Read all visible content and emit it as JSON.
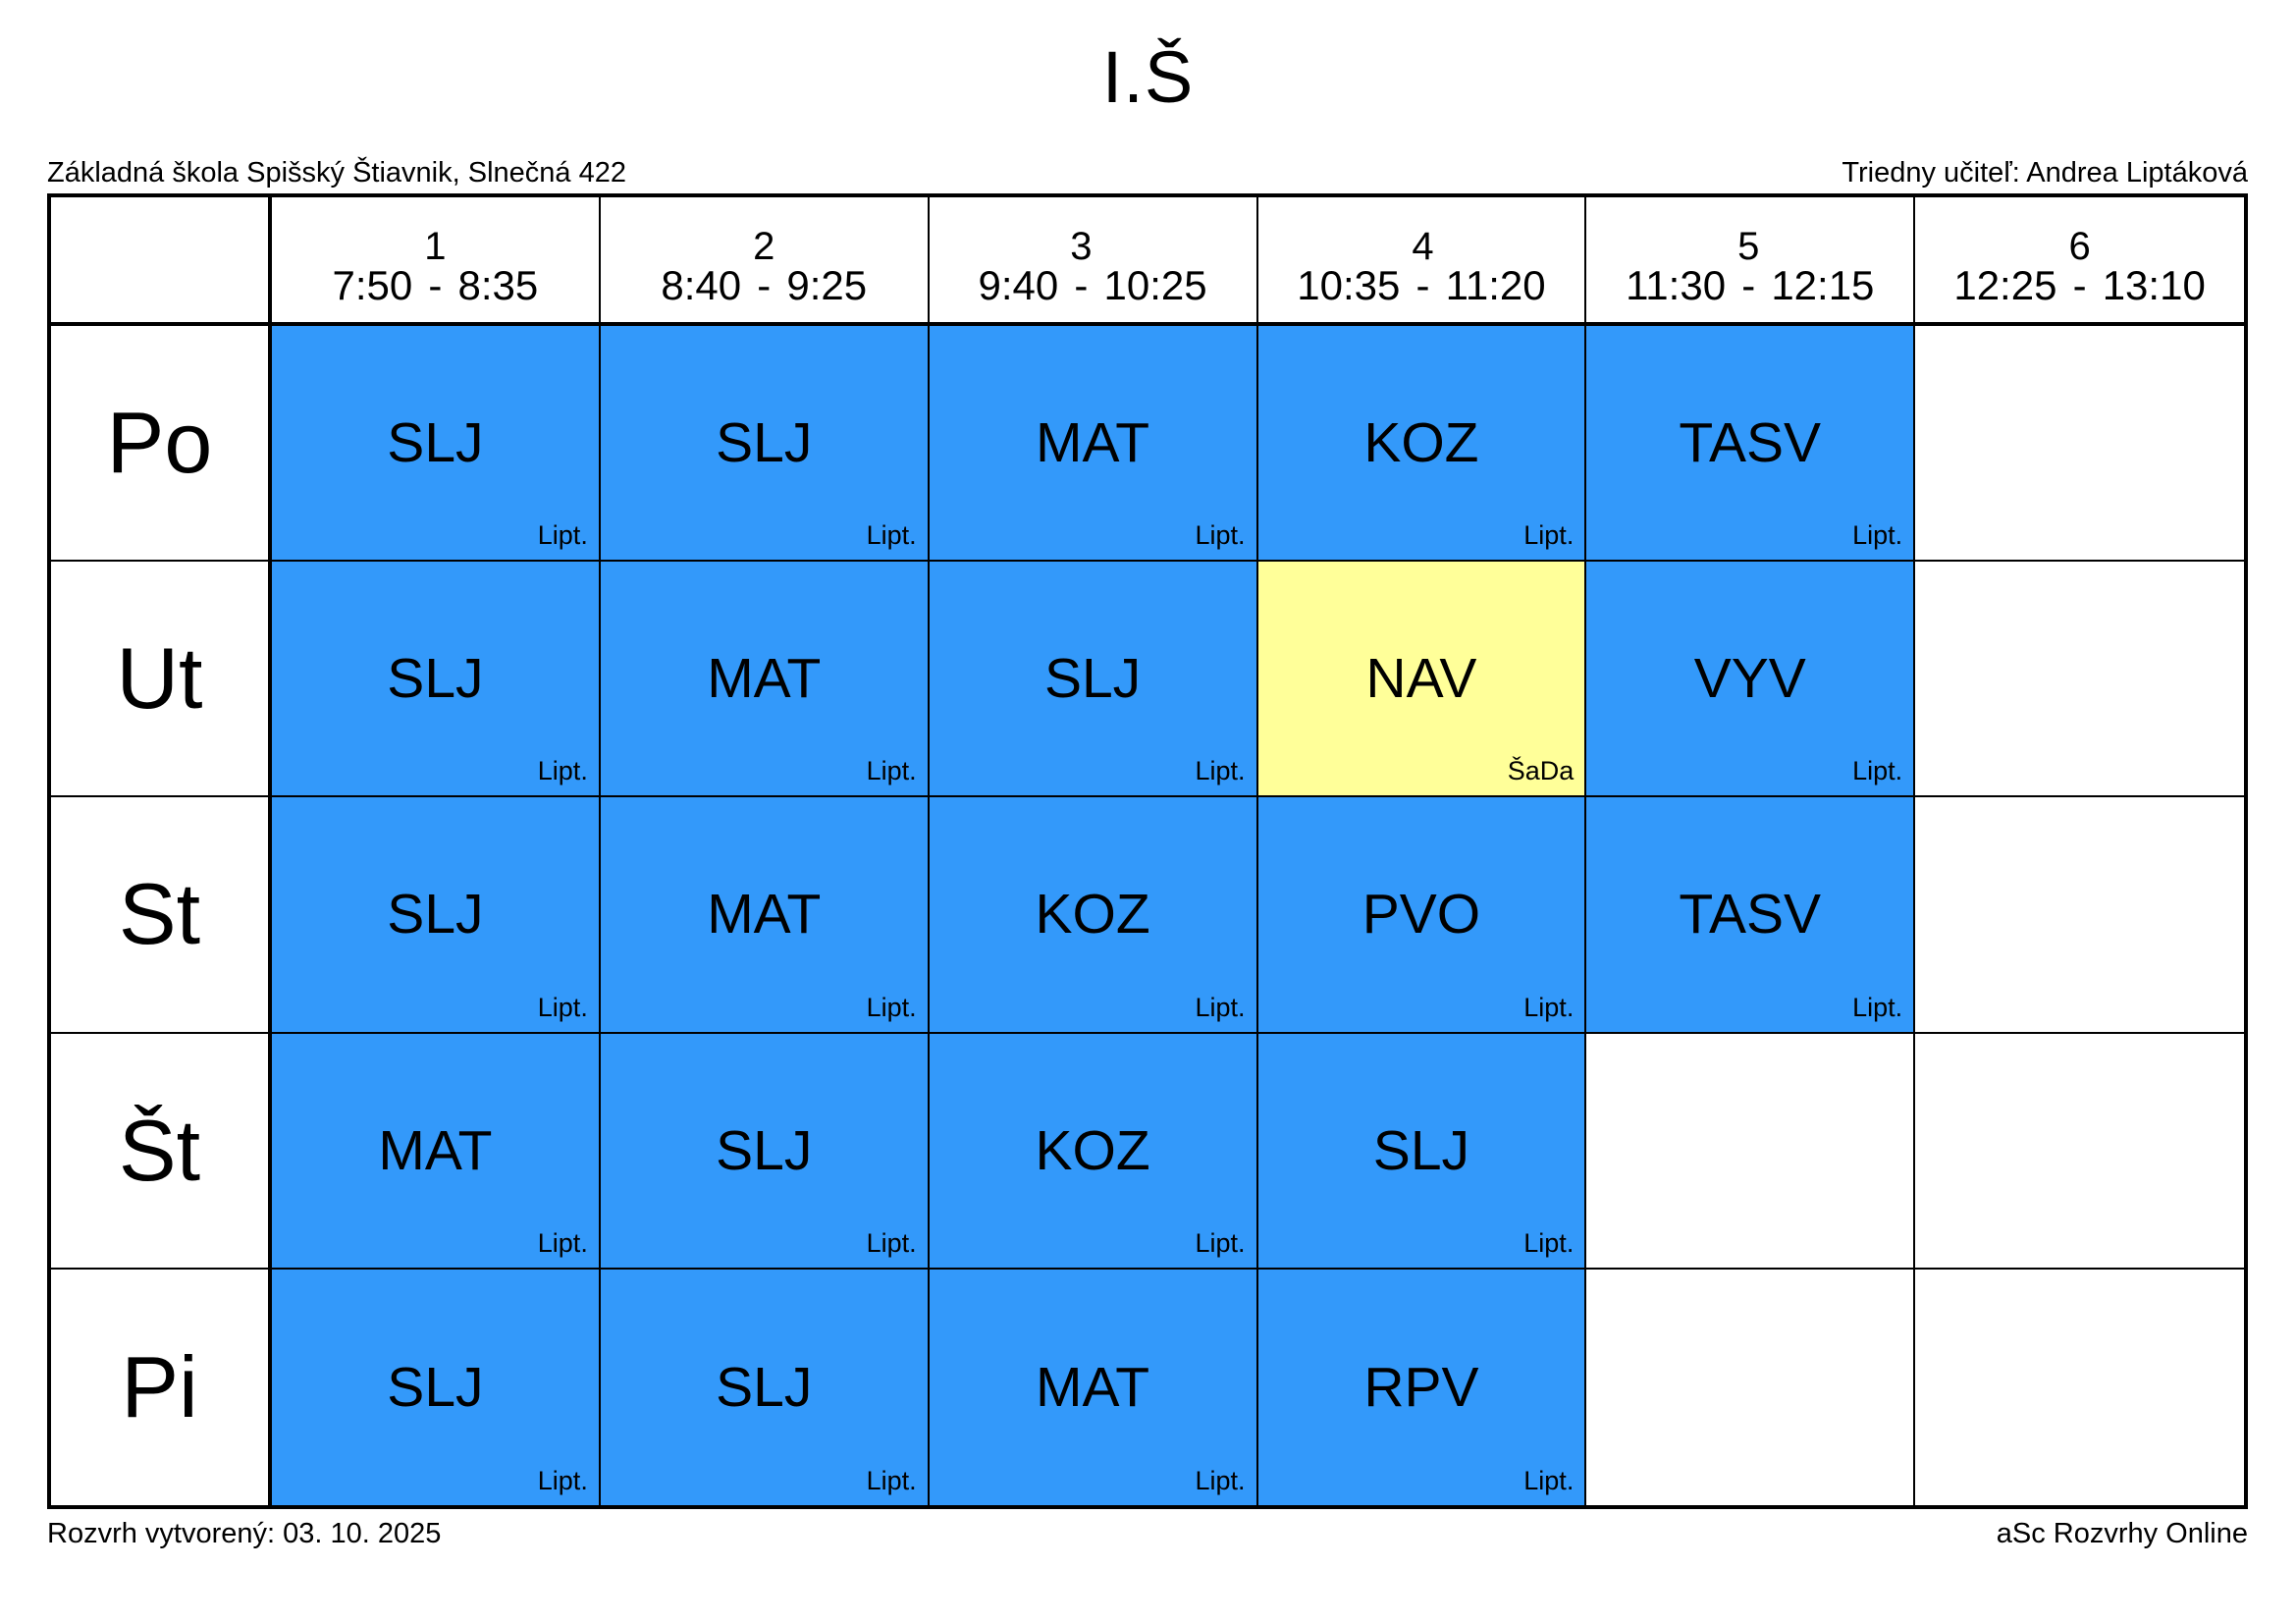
{
  "title": "I.Š",
  "header": {
    "school": "Základná škola Spišský Štiavnik, Slnečná 422",
    "class_teacher": "Triedny učiteľ: Andrea Liptáková"
  },
  "footer": {
    "created": "Rozvrh vytvorený: 03. 10. 2025",
    "brand": "aSc Rozvrhy Online"
  },
  "time_separator": "-",
  "colors": {
    "blue": "#3399FA",
    "yellow": "#FFFF99",
    "grid": "#000000",
    "background": "#FFFFFF"
  },
  "periods": [
    {
      "num": "1",
      "start": "7:50",
      "end": "8:35"
    },
    {
      "num": "2",
      "start": "8:40",
      "end": "9:25"
    },
    {
      "num": "3",
      "start": "9:40",
      "end": "10:25"
    },
    {
      "num": "4",
      "start": "10:35",
      "end": "11:20"
    },
    {
      "num": "5",
      "start": "11:30",
      "end": "12:15"
    },
    {
      "num": "6",
      "start": "12:25",
      "end": "13:10"
    }
  ],
  "days": [
    {
      "label": "Po",
      "lessons": [
        {
          "subject": "SLJ",
          "teacher": "Lipt.",
          "color": "blue"
        },
        {
          "subject": "SLJ",
          "teacher": "Lipt.",
          "color": "blue"
        },
        {
          "subject": "MAT",
          "teacher": "Lipt.",
          "color": "blue"
        },
        {
          "subject": "KOZ",
          "teacher": "Lipt.",
          "color": "blue"
        },
        {
          "subject": "TASV",
          "teacher": "Lipt.",
          "color": "blue"
        },
        null
      ]
    },
    {
      "label": "Ut",
      "lessons": [
        {
          "subject": "SLJ",
          "teacher": "Lipt.",
          "color": "blue"
        },
        {
          "subject": "MAT",
          "teacher": "Lipt.",
          "color": "blue"
        },
        {
          "subject": "SLJ",
          "teacher": "Lipt.",
          "color": "blue"
        },
        {
          "subject": "NAV",
          "teacher": "ŠaDa",
          "color": "yellow"
        },
        {
          "subject": "VYV",
          "teacher": "Lipt.",
          "color": "blue"
        },
        null
      ]
    },
    {
      "label": "St",
      "lessons": [
        {
          "subject": "SLJ",
          "teacher": "Lipt.",
          "color": "blue"
        },
        {
          "subject": "MAT",
          "teacher": "Lipt.",
          "color": "blue"
        },
        {
          "subject": "KOZ",
          "teacher": "Lipt.",
          "color": "blue"
        },
        {
          "subject": "PVO",
          "teacher": "Lipt.",
          "color": "blue"
        },
        {
          "subject": "TASV",
          "teacher": "Lipt.",
          "color": "blue"
        },
        null
      ]
    },
    {
      "label": "Št",
      "lessons": [
        {
          "subject": "MAT",
          "teacher": "Lipt.",
          "color": "blue"
        },
        {
          "subject": "SLJ",
          "teacher": "Lipt.",
          "color": "blue"
        },
        {
          "subject": "KOZ",
          "teacher": "Lipt.",
          "color": "blue"
        },
        {
          "subject": "SLJ",
          "teacher": "Lipt.",
          "color": "blue"
        },
        null,
        null
      ]
    },
    {
      "label": "Pi",
      "lessons": [
        {
          "subject": "SLJ",
          "teacher": "Lipt.",
          "color": "blue"
        },
        {
          "subject": "SLJ",
          "teacher": "Lipt.",
          "color": "blue"
        },
        {
          "subject": "MAT",
          "teacher": "Lipt.",
          "color": "blue"
        },
        {
          "subject": "RPV",
          "teacher": "Lipt.",
          "color": "blue"
        },
        null,
        null
      ]
    }
  ]
}
